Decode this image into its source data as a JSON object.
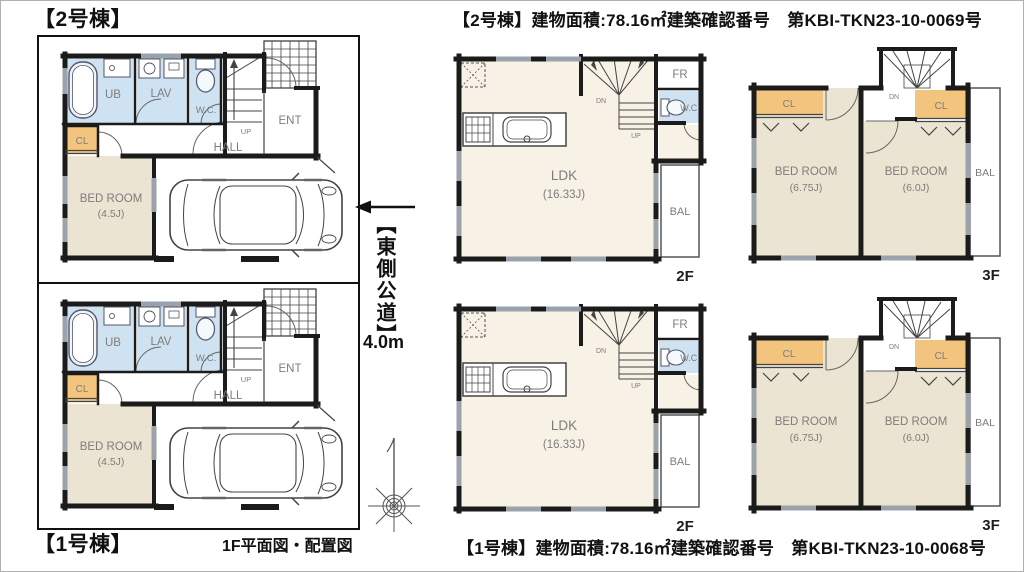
{
  "colors": {
    "wall": "#1b1b1b",
    "beige": "#ece4d2",
    "cream": "#f8f1e6",
    "blue": "#cfe2f1",
    "orange": "#f2c47e",
    "label": "#7d7d7d",
    "window": "#9aa3ab"
  },
  "left_panel": {
    "unit2_label": "【2号棟】",
    "unit1_label": "【1号棟】",
    "caption": "1F平面図・配置図"
  },
  "road": {
    "label": "【東側公道】",
    "width": "4.0m"
  },
  "right_panel": {
    "unit2_header": "【2号棟】建物面積:78.16㎡建築確認番号　第KBI-TKN23-10-0069号",
    "unit1_footer": "【1号棟】建物面積:78.16㎡建築確認番号　第KBI-TKN23-10-0068号"
  },
  "plan_1f": {
    "ub": "UB",
    "lav": "LAV",
    "wc": "W.C.",
    "cl": "CL",
    "ent": "ENT",
    "hall": "HALL",
    "up": "UP",
    "bedroom": "BED ROOM",
    "bedroom_size": "(4.5J)"
  },
  "plan_2f": {
    "ldk": "LDK",
    "ldk_size": "(16.33J)",
    "fr": "FR",
    "wc": "W.C.",
    "bal": "BAL",
    "dn": "DN",
    "up": "UP",
    "floor": "2F"
  },
  "plan_3f": {
    "bedroom_left": "BED ROOM",
    "bedroom_left_size": "(6.75J)",
    "bedroom_right": "BED ROOM",
    "bedroom_right_size": "(6.0J)",
    "cl_left": "CL",
    "cl_right": "CL",
    "bal": "BAL",
    "dn": "DN",
    "floor": "3F"
  }
}
